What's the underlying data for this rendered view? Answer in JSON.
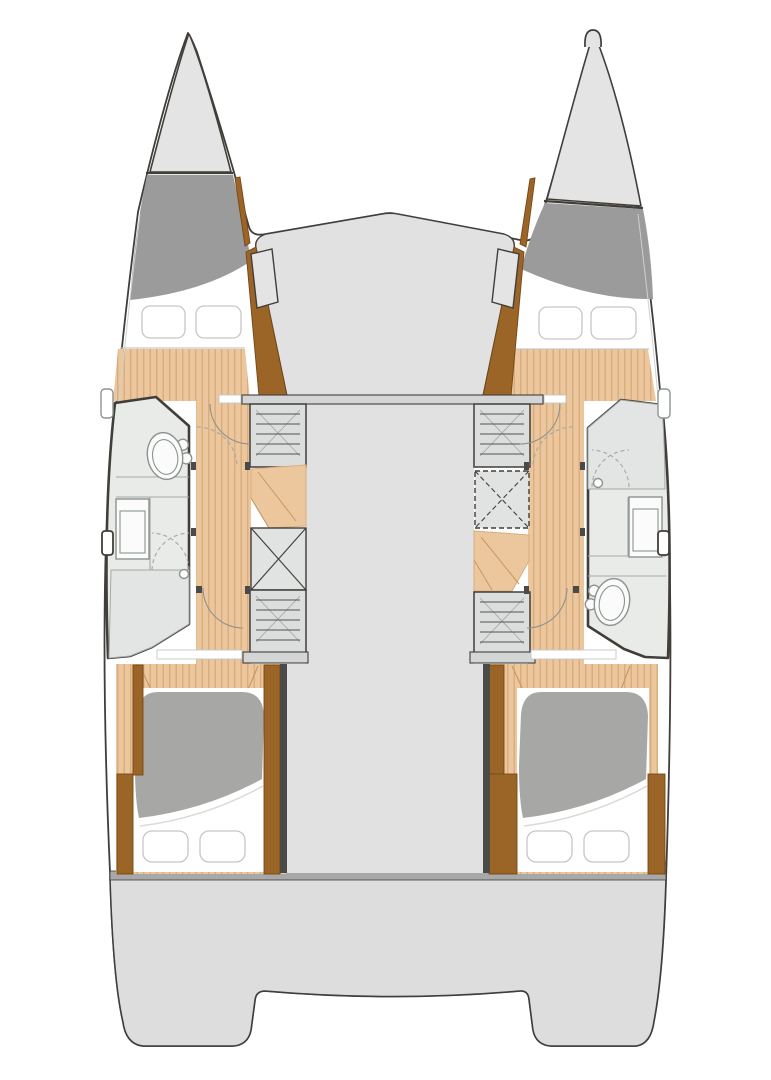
{
  "page": {
    "title": "Catamaran lower-deck floor plan",
    "width_px": 771,
    "height_px": 1080
  },
  "plan": {
    "type": "floor-plan",
    "view": "top-down deck plan of a sailing catamaran, four-cabin two-head layout",
    "center": {
      "areas": [
        {
          "name": "bridge-deck",
          "description": "peaked forward bridge deck between the hulls"
        },
        {
          "name": "central-corridor",
          "description": "plain grey saloon sole between hull cabinetry"
        },
        {
          "name": "transom-step",
          "description": "full-width step bar across the stern"
        },
        {
          "name": "stern-platform",
          "description": "aft platform with twin transoms and central notch"
        }
      ]
    },
    "left_hull": {
      "rooms": [
        {
          "name": "bow-tip",
          "feature": "pointed bow with anchor locker behind deck line"
        },
        {
          "name": "forward-berth",
          "pillows": 2
        },
        {
          "name": "head-compartment",
          "fixtures": [
            "toilet",
            "vanity-sink",
            "shower-with-drain"
          ],
          "toilet_position": "forward",
          "shower_position": "aft"
        },
        {
          "name": "cabinet-column",
          "units": [
            "drawer-unit",
            "wood-steps",
            "x-locker",
            "drawer-unit"
          ]
        },
        {
          "name": "walkway",
          "sole": "wood-planks",
          "door_arcs": 2
        },
        {
          "name": "aft-berth",
          "bedding": [
            "grey-duvet",
            "white-sheet"
          ],
          "pillows": 2
        },
        {
          "name": "hull-side-openings",
          "items": [
            "porthole",
            "side-hatch"
          ]
        }
      ]
    },
    "right_hull": {
      "rooms": [
        {
          "name": "bow-tip",
          "feature": "pointed bow with bow-roller loop and anchor locker"
        },
        {
          "name": "forward-berth",
          "pillows": 2
        },
        {
          "name": "head-compartment",
          "fixtures": [
            "shower-with-drain",
            "vanity-sink",
            "toilet"
          ],
          "toilet_position": "aft",
          "shower_position": "forward"
        },
        {
          "name": "cabinet-column",
          "units": [
            "drawer-unit",
            "dashed-x-locker",
            "wood-steps",
            "drawer-unit"
          ]
        },
        {
          "name": "walkway",
          "sole": "wood-planks",
          "door_arcs": 2
        },
        {
          "name": "aft-berth",
          "bedding": [
            "grey-duvet",
            "white-sheet"
          ],
          "pillows": 2
        },
        {
          "name": "hull-side-openings",
          "items": [
            "porthole",
            "side-hatch"
          ]
        }
      ]
    },
    "totals": {
      "berths": 4,
      "pillows": 8,
      "toilets": 2,
      "showers": 2,
      "sinks": 2
    }
  },
  "colors": {
    "paper": "#ffffff",
    "outline": "#413e3a",
    "deck_light": "#e3e4e3",
    "deck_mid": "#dcdddc",
    "bridge": "#e0e1e0",
    "band": "#a7a8a7",
    "step_strip": "#c2c4c3",
    "locker": "#9a9b9a",
    "duvet": "#a7a7a5",
    "sheet_line": "#d9d9d7",
    "wood_base": "#ecc79e",
    "wood_stripe": "#d9ac7d",
    "vee": "#c6985f",
    "brown": "#9b6527",
    "brown_dark": "#774716",
    "bath": "#e9ebe9",
    "bath_floor": "#e2e5e3",
    "bath_line": "#a3a9a6",
    "fixture": "#fbfbfb",
    "fixture_line": "#8d938f",
    "cabinet": "#dcdedd",
    "xsquare": "#e1e3e2",
    "bar": "#d4d6d5",
    "hatch": "#55524f",
    "wall": "#4a4a49",
    "pillow_line": "#c5c7c6",
    "sheer": "#cfd1d0"
  }
}
